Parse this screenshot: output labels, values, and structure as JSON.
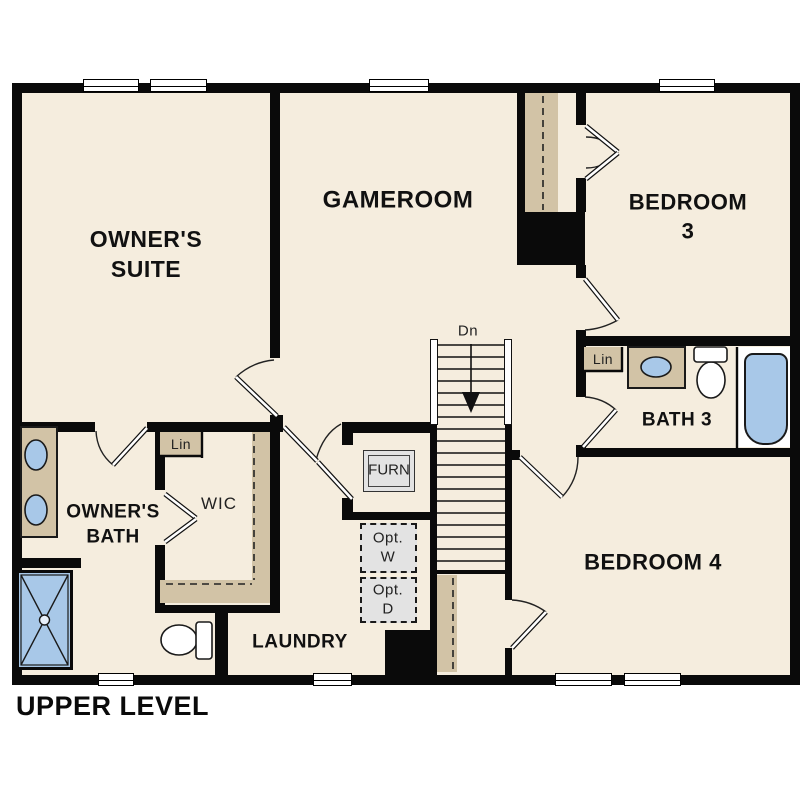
{
  "plan": {
    "title": "UPPER LEVEL",
    "level": "upper"
  },
  "rooms": {
    "owners_suite": {
      "label": "OWNER'S\nSUITE"
    },
    "gameroom": {
      "label": "GAMEROOM"
    },
    "bedroom3": {
      "label": "BEDROOM 3"
    },
    "bedroom4": {
      "label": "BEDROOM 4"
    },
    "bath3": {
      "label": "BATH 3"
    },
    "owners_bath": {
      "label": "OWNER'S\nBATH"
    },
    "wic": {
      "label": "WIC"
    },
    "laundry": {
      "label": "LAUNDRY"
    }
  },
  "annotations": {
    "stairs_down": "Dn",
    "linen_owner": "Lin",
    "linen_bath3": "Lin",
    "furnace": "FURN",
    "opt_washer": "Opt.\nW",
    "opt_dryer": "Opt.\nD"
  },
  "fixtures": [
    "double-vanity-sinks",
    "walk-in-shower",
    "toilet-owner-bath",
    "single-vanity-sink",
    "toilet-bath3",
    "bathtub",
    "stairs-down",
    "closet-rods"
  ],
  "colors": {
    "wall": "#0a0a0a",
    "floor": "#f5edde",
    "cabinetry_tan": "#d2c3a6",
    "fixture_blue": "#a8c8e8",
    "optional_gray": "#e3e3e3",
    "background": "#ffffff"
  }
}
